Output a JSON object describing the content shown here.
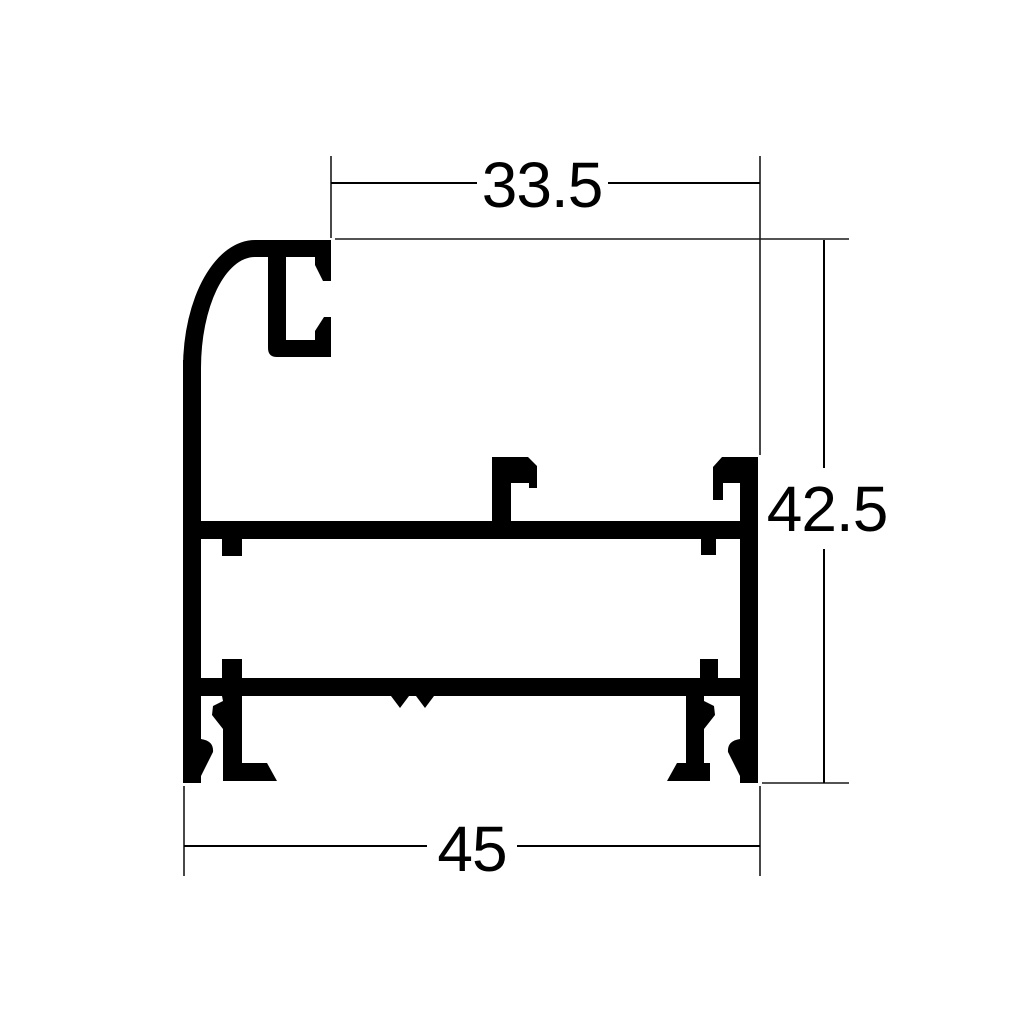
{
  "page": {
    "background": "#ffffff"
  },
  "drawing": {
    "subject": "aluminium-profile-cross-section",
    "line_color": "#000000",
    "fill_color": "#000000",
    "dimensions": {
      "top_width": "33.5",
      "right_height": "42.5",
      "bottom_width": "45"
    }
  }
}
